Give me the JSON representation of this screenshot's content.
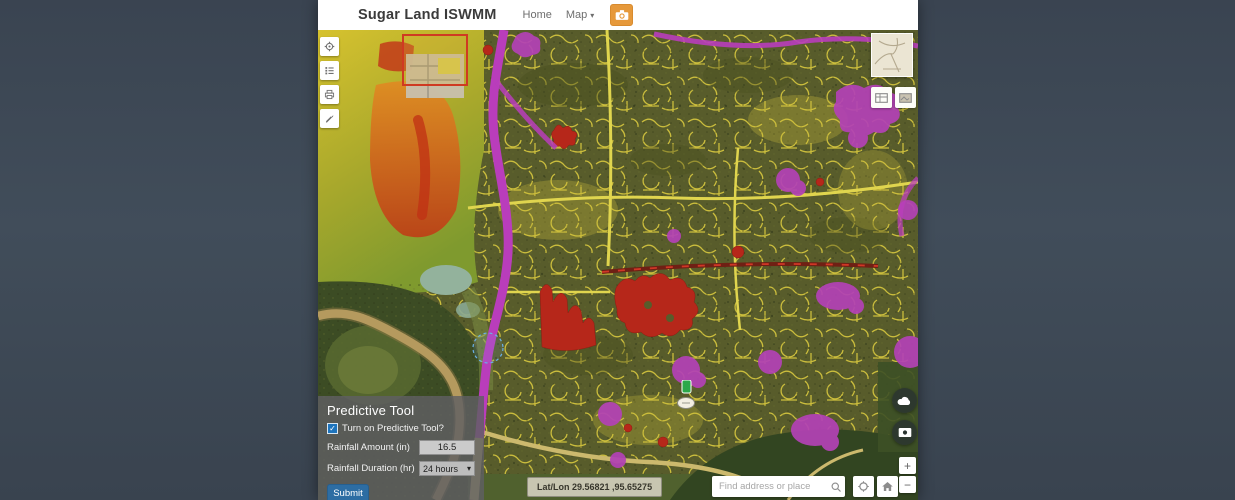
{
  "header": {
    "title": "Sugar Land ISWMM",
    "nav_home": "Home",
    "nav_map": "Map"
  },
  "icons": {
    "nav_caret": "▾",
    "select_caret": "▾",
    "check": "✓",
    "zoom_in": "+",
    "zoom_out": "−"
  },
  "map_overlay": {
    "latlon": "Lat/Lon 29.56821 ,95.65275",
    "search_placeholder": "Find address or place"
  },
  "predictive_tool": {
    "title": "Predictive Tool",
    "checkbox_label": "Turn on Predictive Tool?",
    "checkbox_checked": true,
    "rainfall_amount_label": "Rainfall Amount (in)",
    "rainfall_amount_value": "16.5",
    "rainfall_duration_label": "Rainfall Duration (hr)",
    "rainfall_duration_value": "24 hours",
    "submit_label": "Submit"
  },
  "legend_colors": {
    "flood_red": "#b6271a",
    "flood_magenta": "#b342b5",
    "highway_magenta": "#b93dbb",
    "streets_yellow": "#d7c83e",
    "accent_orange": "#e6993b",
    "accent_blue": "#2d6da3"
  }
}
